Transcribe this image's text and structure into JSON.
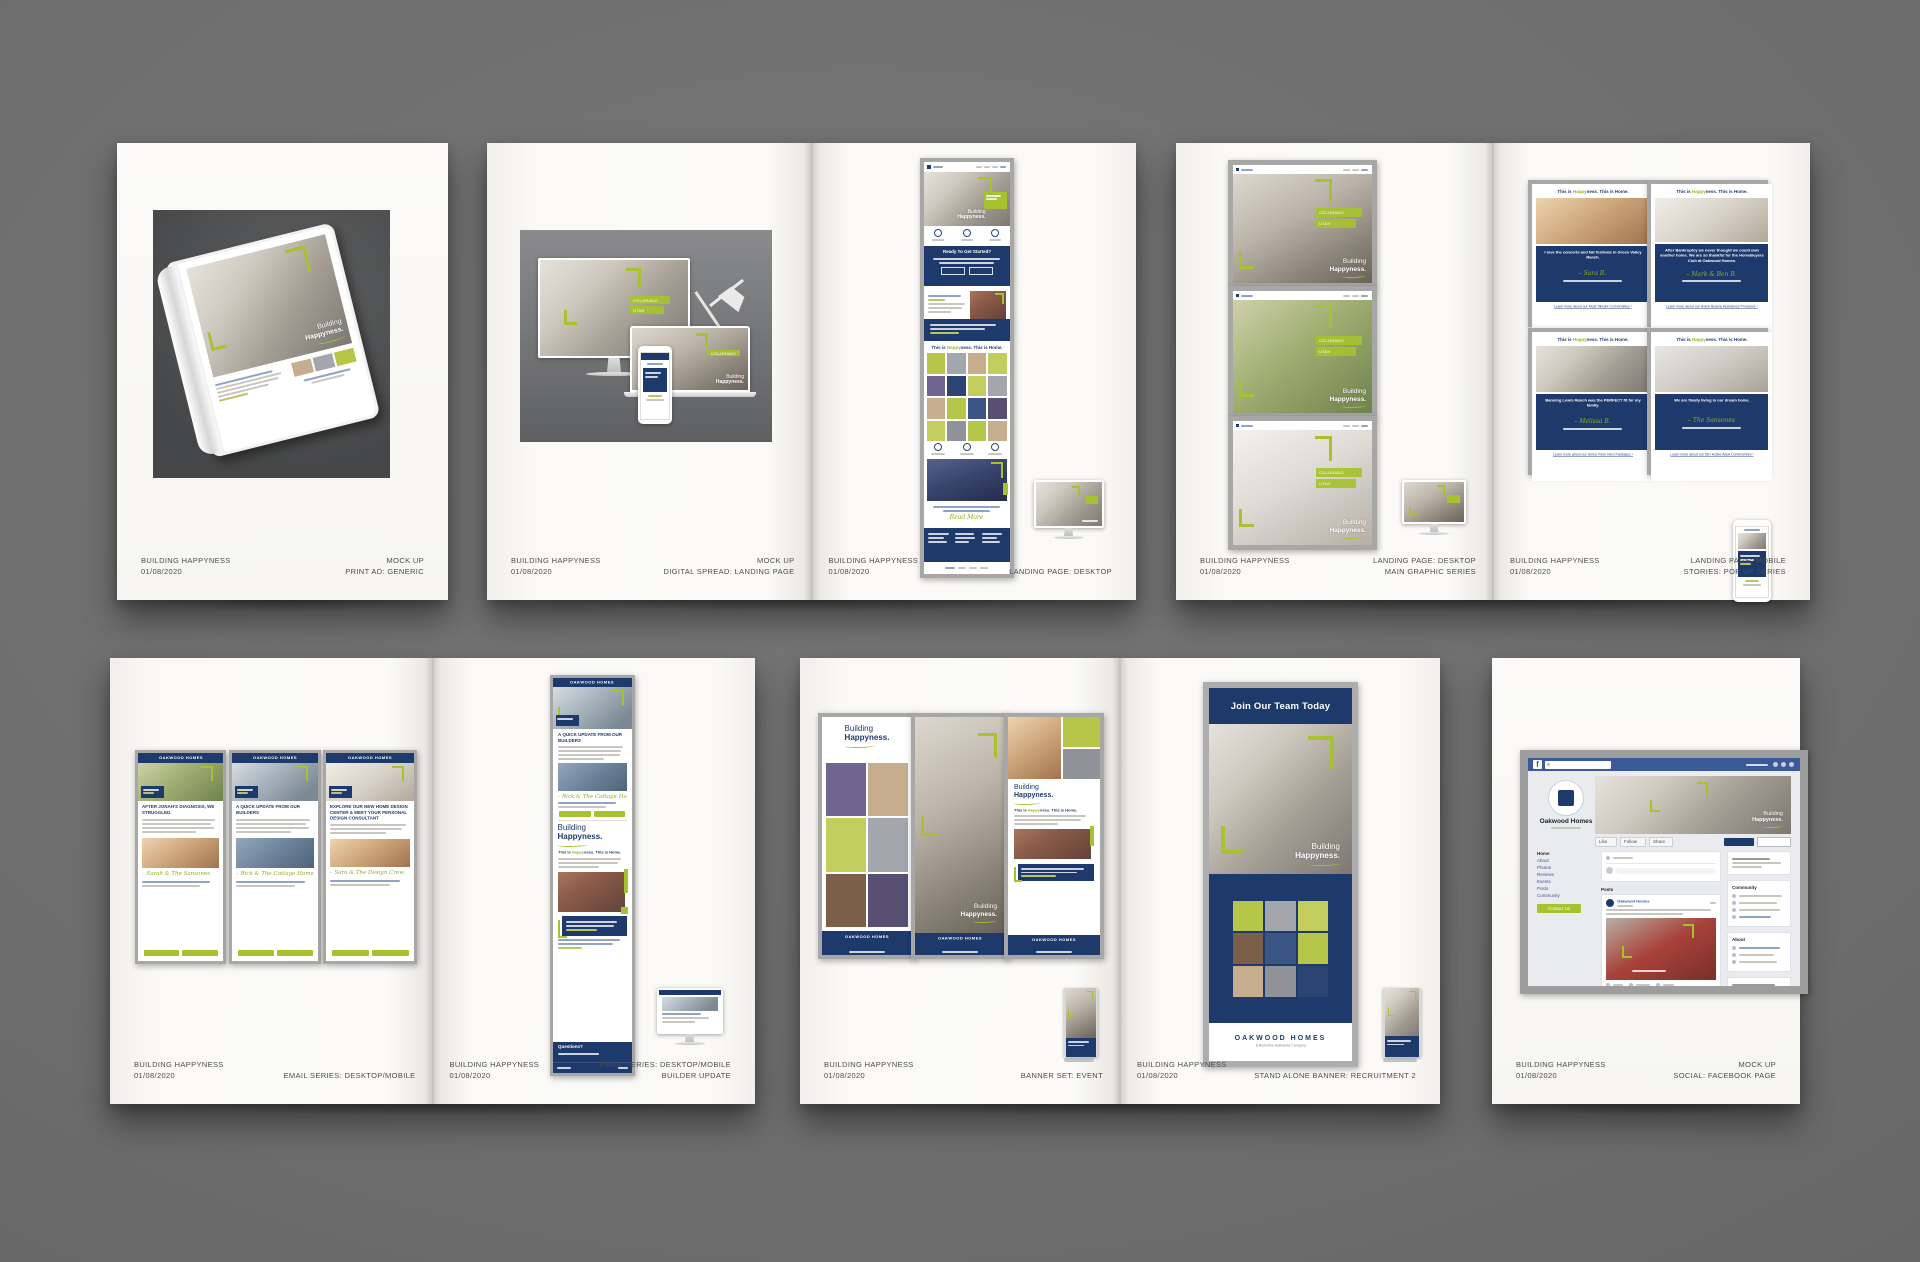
{
  "project": {
    "title": "BUILDING HAPPYNESS",
    "date": "01/08/2020"
  },
  "brand": {
    "name": "OAKWOOD HOMES",
    "tagline": "A Berkshire Hathaway Company",
    "campaign": {
      "line1": "Building",
      "line2": "Happyness."
    },
    "this_is": {
      "pre": "This is ",
      "green": "Happy",
      "post": "ness. This is Home."
    },
    "colors": {
      "navy": "#1e3a6d",
      "green": "#a6c22e",
      "facebook_blue": "#3c5a99",
      "frame_gray": "#a7a7a7",
      "background_gray": "#6d6d6d"
    }
  },
  "location_buttons": {
    "colorado": "COLORADO",
    "utah": "UTAH"
  },
  "sheets": {
    "print_ad": {
      "footer_right": [
        "MOCK UP",
        "PRINT AD: GENERIC"
      ]
    },
    "digital_spread": {
      "footer_right": [
        "MOCK UP",
        "DIGITAL SPREAD: LANDING PAGE"
      ]
    },
    "landing_desktop": {
      "footer_right": [
        "LANDING PAGE: DESKTOP"
      ],
      "cta_heading": "Ready To Get Started?",
      "read_more": "Read More"
    },
    "graphic_series": {
      "footer_right": [
        "LANDING PAGE: DESKTOP",
        "MAIN GRAPHIC SERIES"
      ]
    },
    "pop_up_series": {
      "footer_right": [
        "LANDING PAGE: MOBILE",
        "STORIES: POP UP SERIES"
      ],
      "cards": [
        {
          "quote": "I love the concerts and fall festivals in Green Valley Ranch.",
          "signature": "– Sara B.",
          "link": "Learn more about our Most Vibrant Communities ›"
        },
        {
          "quote": "After Bankruptcy we never thought we could own another home. We are so thankful for the HomeBuyers Club at Oakwood Homes.",
          "signature": "– Mark & Ben B.",
          "link": "Learn more about our Home Buying Assistance Programs ›"
        },
        {
          "quote": "Banning Lewis Ranch was the PERFECT fit for my family.",
          "signature": "– Melissa B.",
          "link": "Learn more about our Home Town Hero Packages ›"
        },
        {
          "quote": "We are finally living in our dream home.",
          "signature": "– The Sansones",
          "link": "Learn more about our 55+ Active Adult Communities ›"
        }
      ]
    },
    "email_series": {
      "footer_right": [
        "EMAIL SERIES: DESKTOP/MOBILE"
      ],
      "emails": [
        {
          "headline": "AFTER JONAH'S DIAGNOSIS, WE STRUGGLED.",
          "signature": "– Sarah & The Sansones"
        },
        {
          "headline": "A QUICK UPDATE FROM OUR BUILDERS",
          "signature": "– Rick & The Cottage Home Crew"
        },
        {
          "headline": "EXPLORE OUR NEW HOME DESIGN CENTER & MEET YOUR PERSONAL DESIGN CONSULTANT",
          "signature": "– Sara & The Design Crew"
        }
      ]
    },
    "builder_update": {
      "footer_right": [
        "EMAIL SERIES: DESKTOP/MOBILE",
        "BUILDER UPDATE"
      ],
      "headline": "A QUICK UPDATE FROM OUR BUILDERS",
      "signature": "– Rick & The Cottage Home Crew",
      "questions_heading": "Questions?"
    },
    "banner_set": {
      "footer_right": [
        "BANNER SET: EVENT"
      ]
    },
    "recruitment_banner": {
      "footer_right": [
        "STAND ALONE BANNER: RECRUITMENT 2"
      ],
      "headline": "Join Our Team Today"
    },
    "facebook": {
      "footer_right": [
        "MOCK UP",
        "SOCIAL: FACEBOOK PAGE"
      ],
      "page_name": "Oakwood Homes",
      "menu": [
        "Home",
        "About",
        "Photos",
        "Reviews",
        "Events",
        "Posts",
        "Community"
      ],
      "contact_button": "Contact Us",
      "actions": [
        "Like",
        "Follow",
        "Share"
      ],
      "posts_label": "Posts",
      "community_label": "Community",
      "about_label": "About"
    }
  }
}
